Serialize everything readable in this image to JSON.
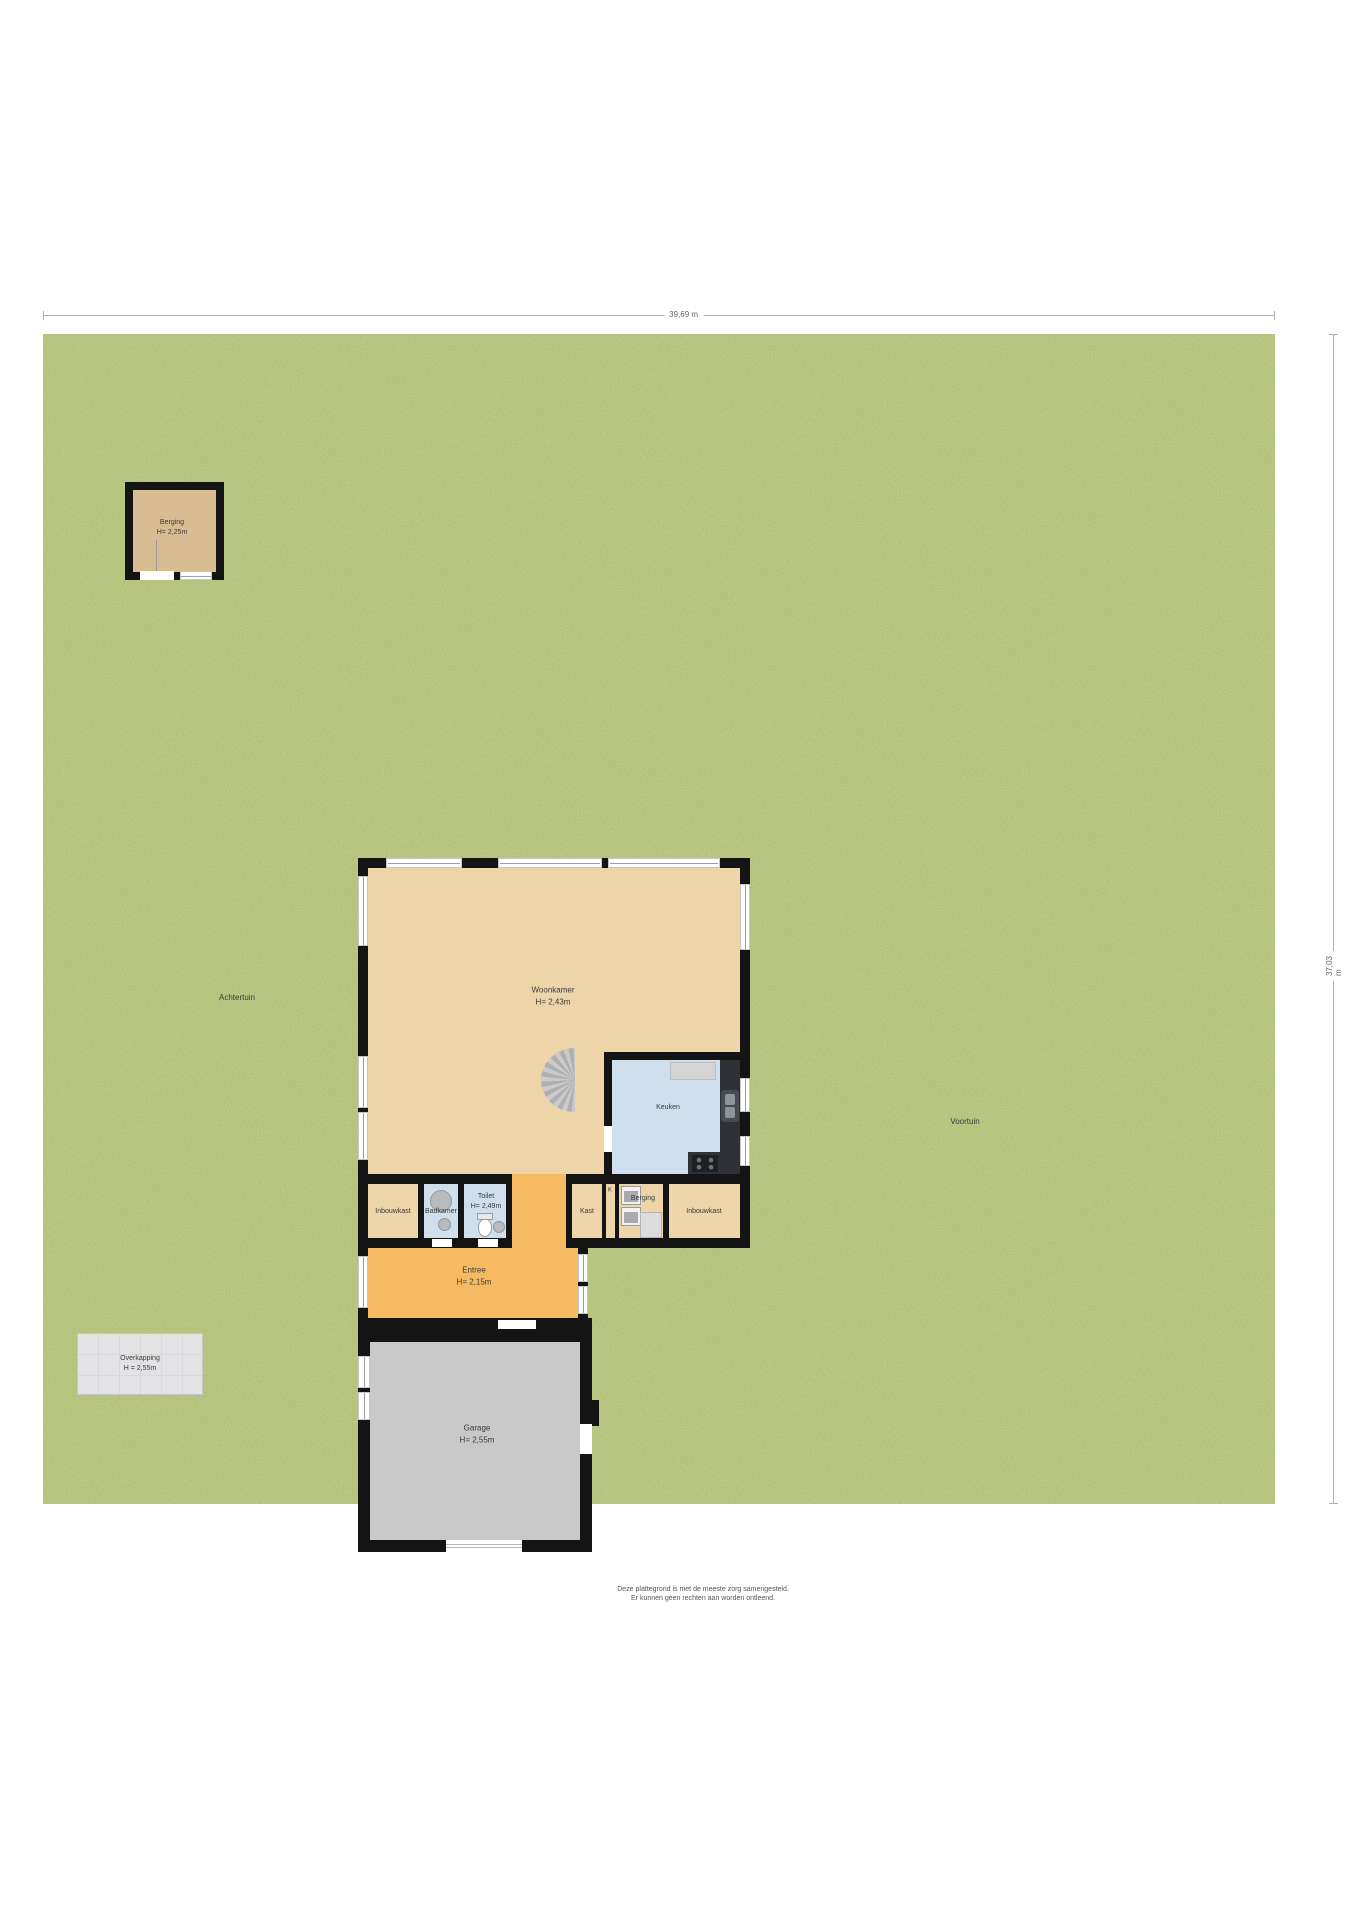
{
  "dims": {
    "top": "39,69 m",
    "right": "37,03 m"
  },
  "garden": {
    "back": "Achtertuin",
    "front": "Voortuin"
  },
  "shed": {
    "name": "Berging",
    "height": "H= 2,25m"
  },
  "overkapping": {
    "name": "Overkapping",
    "height": "H = 2,55m"
  },
  "rooms": {
    "woonkamer": {
      "name": "Woonkamer",
      "height": "H= 2,43m"
    },
    "keuken": {
      "name": "Keuken"
    },
    "inbouwkast_left": {
      "name": "Inbouwkast"
    },
    "badkamer": {
      "name": "Badkamer"
    },
    "toilet": {
      "name": "Toilet",
      "height": "H= 2,49m"
    },
    "kast": {
      "name": "Kast"
    },
    "k": {
      "name": "K"
    },
    "berging": {
      "name": "Berging"
    },
    "inbouwkast_right": {
      "name": "Inbouwkast"
    },
    "entree": {
      "name": "Entree",
      "height": "H= 2,15m"
    },
    "garage": {
      "name": "Garage",
      "height": "H= 2,55m"
    }
  },
  "disclaimer": {
    "line1": "Deze plattegrond is met de meeste zorg samengesteld.",
    "line2": "Er kunnen geen rechten aan worden ontleend."
  },
  "colors": {
    "grass": "#7a8b3e",
    "floor-tan": "#eed4a9",
    "floor-blue": "#cfdfee",
    "floor-orange": "#f6ba62",
    "floor-gray": "#c9c9c9",
    "shed-tan": "#d8bd93",
    "wall": "#141414",
    "counter": "#2e3236",
    "overkapping": "#e3e3e5"
  }
}
